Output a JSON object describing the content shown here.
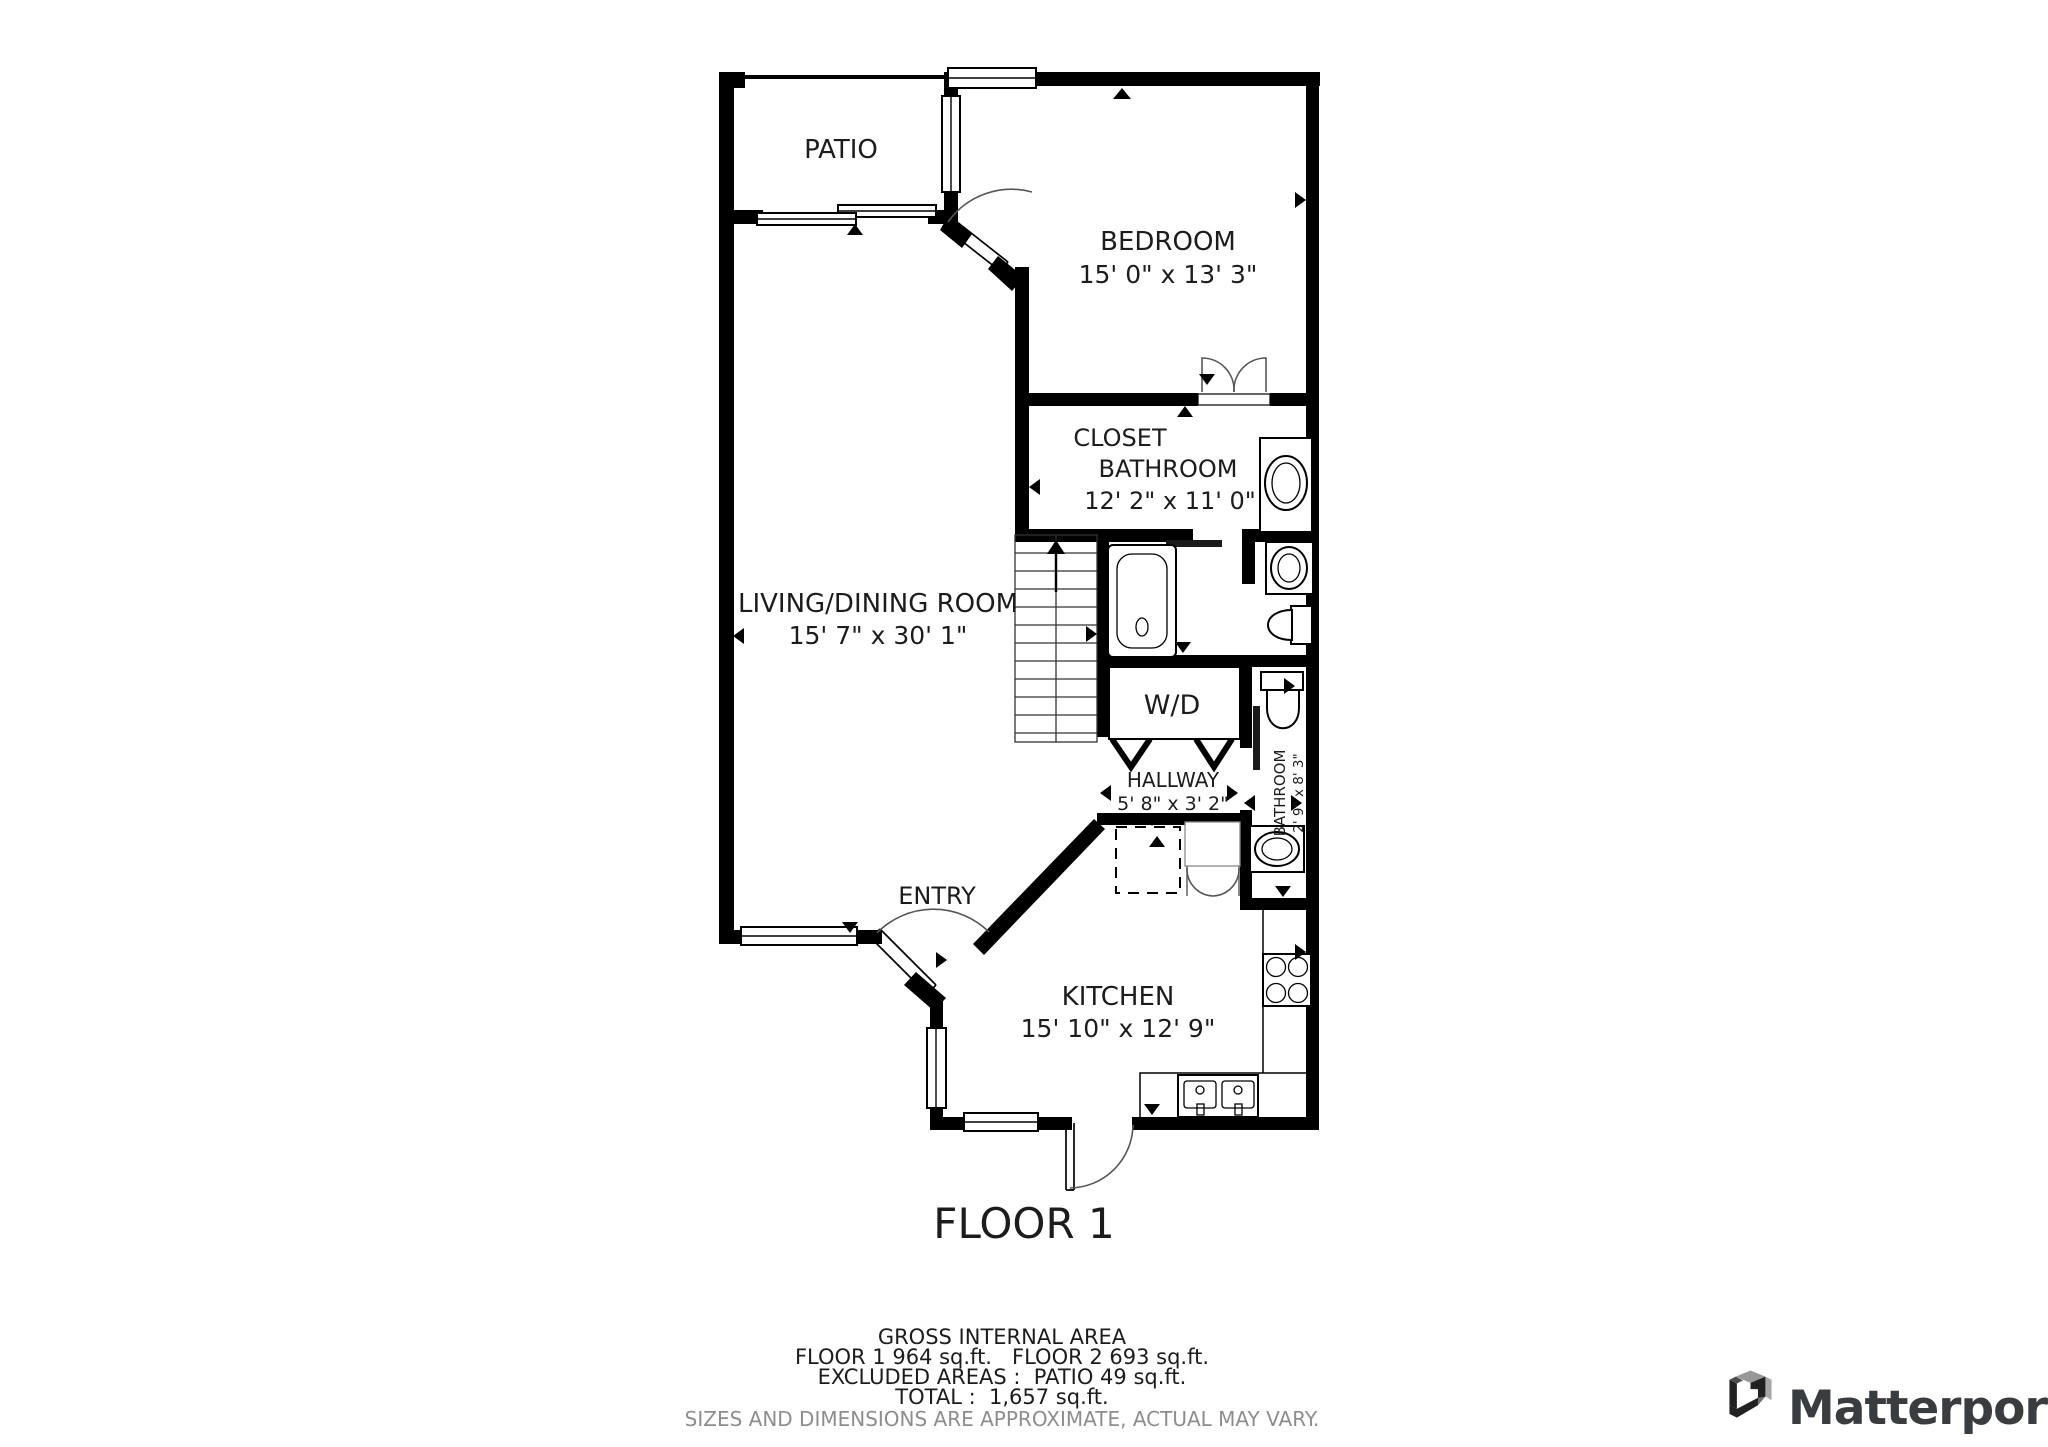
{
  "floor_plan": {
    "title": "FLOOR 1",
    "rooms": {
      "patio": {
        "label": "PATIO"
      },
      "bedroom": {
        "label": "BEDROOM",
        "dims": "15' 0\" x 13' 3\""
      },
      "closet": {
        "label": "CLOSET"
      },
      "bathroom_main": {
        "label": "BATHROOM",
        "dims": "12' 2\" x 11' 0\""
      },
      "living_dining": {
        "label": "LIVING/DINING ROOM",
        "dims": "15' 7\" x 30' 1\""
      },
      "washer_dryer": {
        "label": "W/D"
      },
      "hallway": {
        "label": "HALLWAY",
        "dims": "5' 8\" x 3' 2\""
      },
      "bathroom_small": {
        "label": "BATHROOM",
        "dims": "2' 9\" x 8' 3\""
      },
      "entry": {
        "label": "ENTRY"
      },
      "kitchen": {
        "label": "KITCHEN",
        "dims": "15' 10\" x 12' 9\""
      }
    }
  },
  "footer": {
    "gross_internal_area_title": "GROSS INTERNAL AREA",
    "floors_line": "FLOOR 1 964 sq.ft.   FLOOR 2 693 sq.ft.",
    "excluded_line": "EXCLUDED AREAS :  PATIO 49 sq.ft.",
    "total_line": "TOTAL :  1,657 sq.ft.",
    "disclaimer": "SIZES AND DIMENSIONS ARE APPROXIMATE, ACTUAL MAY VARY."
  },
  "branding": {
    "logo_text": "Matterport"
  },
  "colors": {
    "wall": "#000000",
    "label_text": "#1c1c1c",
    "door_arc": "#565656",
    "disclaimer": "#8d8d8d",
    "logo_text": "#3a3d40",
    "logo_dark": "#212121",
    "logo_gray": "#a8a8ab"
  }
}
